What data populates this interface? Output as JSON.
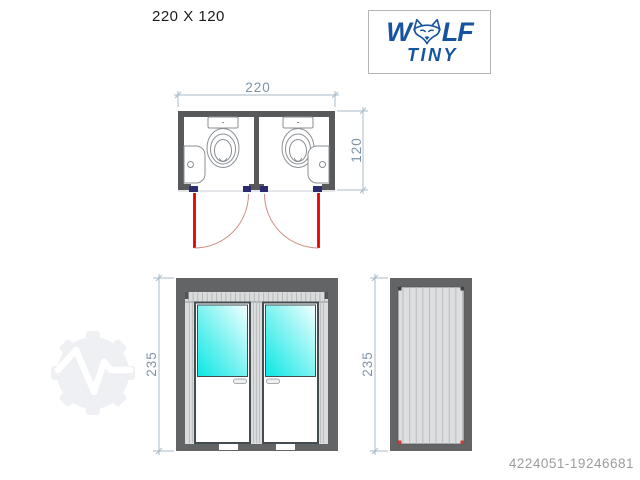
{
  "title": "220 X 120",
  "logo": {
    "word_w": "W",
    "word_lf": "LF",
    "subtitle": "TINY",
    "brand_color": "#17549F"
  },
  "views": {
    "plan": {
      "width_label": "220",
      "depth_label": "120"
    },
    "front": {
      "height_label": "235"
    },
    "side": {
      "height_label": "235"
    }
  },
  "footer": {
    "listing_id": "4224051-19246681"
  },
  "icons": {
    "logo_icon": "wolf-head-icon",
    "watermark_icon": "gear-pulse-icon",
    "plan_fixtures": [
      "toilet-icon",
      "toilet-icon",
      "washbasin-icon",
      "washbasin-icon"
    ]
  },
  "colors": {
    "wall_gray": "#58595b",
    "frame_gray": "#636466",
    "panel_gray": "#dadbdc",
    "glass_cyan": "#0ae7e4",
    "glass_light": "#f2ffff",
    "door_red": "#e60000",
    "swing_arc": "#cf8b80",
    "hinge_navy": "#2b2c6f",
    "dimension": "#7e93a7",
    "id_gray": "#9c9c9c",
    "watermark": "#eef0f3"
  }
}
